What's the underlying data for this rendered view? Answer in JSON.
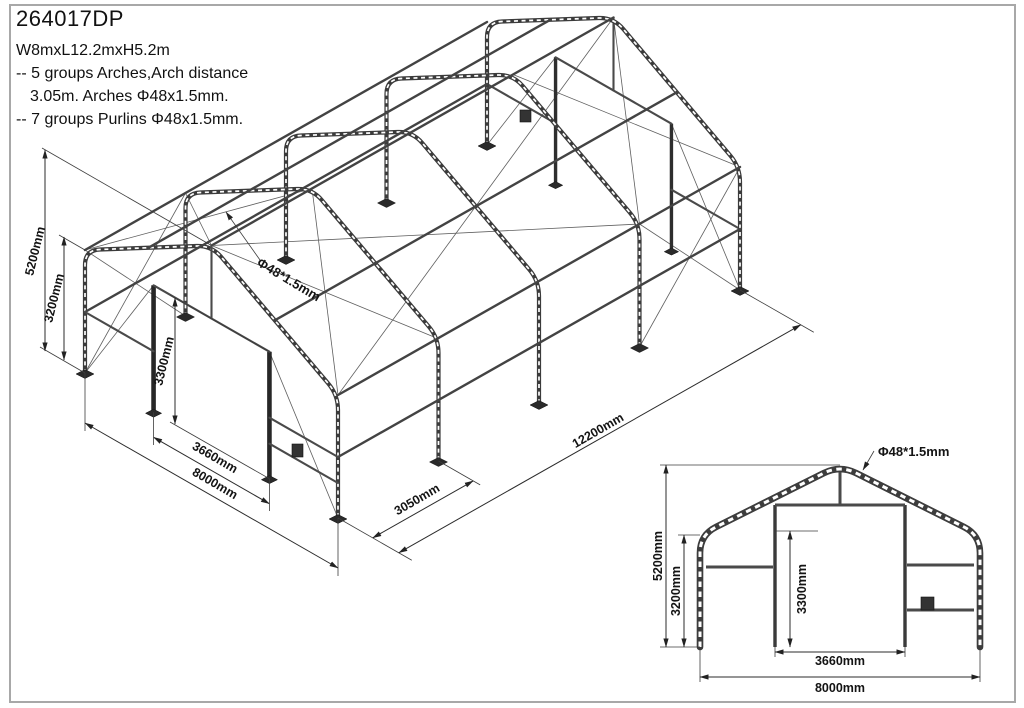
{
  "title_block": {
    "model": "264017DP",
    "size": "W8mxL12.2mxH5.2m",
    "spec_lines": [
      "-- 5 groups Arches,Arch distance",
      "3.05m. Arches Φ48x1.5mm.",
      "-- 7 groups Purlins Φ48x1.5mm."
    ]
  },
  "iso": {
    "dim_5200": "5200mm",
    "dim_3200": "3200mm",
    "dim_3300": "3300mm",
    "dim_3660": "3660mm",
    "dim_8000": "8000mm",
    "dim_3050": "3050mm",
    "dim_12200": "12200mm",
    "tube_label": "Φ48*1.5mm"
  },
  "front": {
    "dim_5200": "5200mm",
    "dim_3200": "3200mm",
    "dim_3300": "3300mm",
    "dim_3660": "3660mm",
    "dim_8000": "8000mm",
    "tube_label": "Φ48*1.5mm"
  }
}
